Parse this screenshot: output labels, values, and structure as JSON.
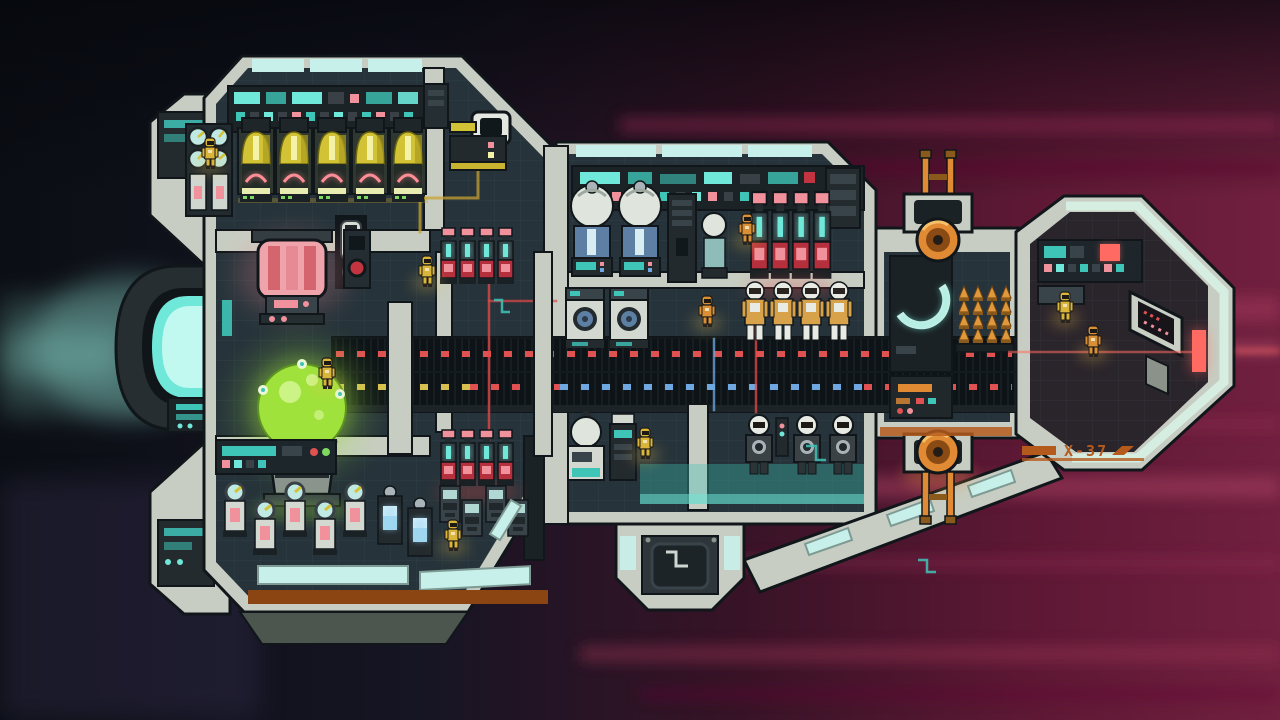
{
  "scene": {
    "type": "game-screenshot",
    "description": "side-view cross-section of a starship travelling through red-streaked space",
    "hud_text_visible": false
  },
  "ship": {
    "hull_label": "X-37",
    "crew_count": 9,
    "rooms": [
      "generator-room",
      "reactor-bay",
      "cargo-hold",
      "life-support-room",
      "suit-locker-room",
      "medbay",
      "weapons-bay",
      "cockpit",
      "central-corridor",
      "airlock"
    ],
    "equipment": {
      "main_engine": 1,
      "generators": 5,
      "battery_capsules": 12,
      "reactor_orb": 1,
      "pink_capacitor": 1,
      "sphere_tanks": 2,
      "washer_units": 2,
      "spacesuits_racked": 4,
      "mech_suits_racked": 3,
      "gauge_canisters": 5,
      "coolant_canisters": 2,
      "storage_lockers": 4,
      "torpedo_columns": 4,
      "turrets": 2,
      "fabricator": 1
    }
  },
  "colors": {
    "bg_left": "#0b0e14",
    "bg_mid": "#151523",
    "bg_crimson": "#5d1834",
    "bg_crimson_bright": "#a63a5c",
    "streak_pink": "#d4647f",
    "exhaust_teal": "#8fe0d2",
    "hull": "#c7cdc2",
    "hull_shade": "#96a096",
    "outline": "#10161a",
    "room": "#26333a",
    "room_dark": "#1b2529",
    "wall_dark": "#232b2f",
    "slat_dark": "#0d1316",
    "glass": "#c8f0ea",
    "teal_bright": "#6fe8da",
    "teal_mid": "#3fc4b8",
    "screen_face": "#bfe9e2",
    "gen_yellow": "#d2c236",
    "gen_slot": "#f4f2a6",
    "pink": "#f0919c",
    "pink_machine": "#efa3ab",
    "pink_glow": "#ff8d96",
    "battery_red": "#b5303c",
    "green": "#9fe23c",
    "green_pale": "#ccf386",
    "blue_body": "#5d7fa3",
    "blue_glow": "#9fd6f0",
    "dot_red": "#e05252",
    "dot_yellow": "#d8c050",
    "dot_blue": "#6fa8e0",
    "dot_green": "#7fd860",
    "crew_yellow": "#d9b53a",
    "crew_orange": "#d98f35",
    "suit_tan": "#d8a24a",
    "torpedo": "#e0983c",
    "turret_orange": "#e08a34",
    "rust": "#8a4512",
    "rust_orange": "#b55a1d",
    "red_bright": "#ff6b63",
    "conduit_red": "#e04848",
    "conduit_yellow": "#c8a232"
  }
}
